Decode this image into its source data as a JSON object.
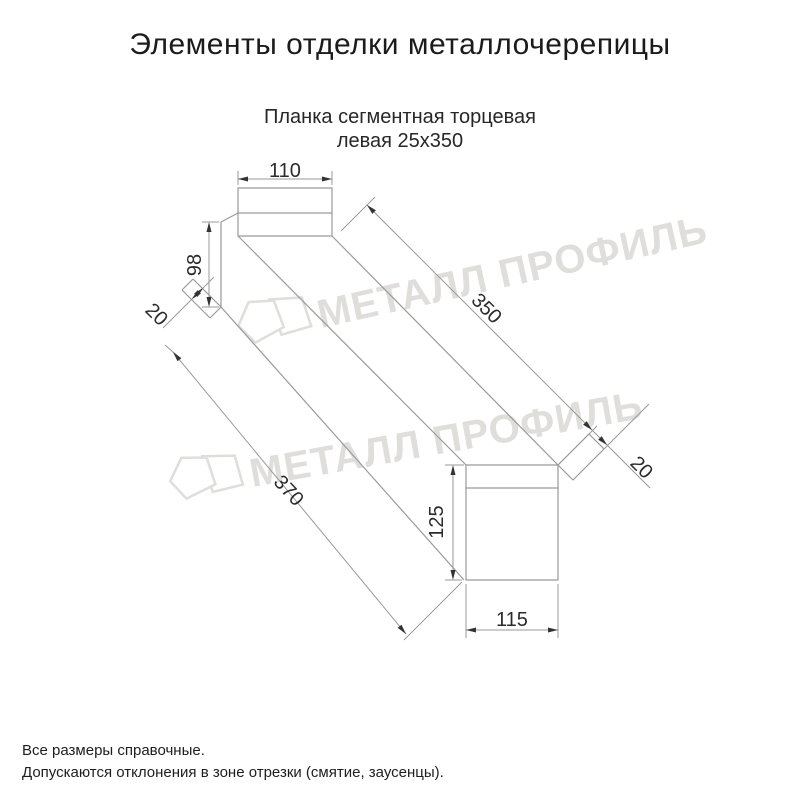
{
  "header": {
    "title": "Элементы отделки металлочерепицы"
  },
  "product": {
    "name_line1": "Планка сегментная торцевая",
    "name_line2": "левая 25х350"
  },
  "drawing": {
    "type": "dimensioned technical drawing of bent metal end strip, oblique view",
    "dimensions": {
      "top_flange_width": "110",
      "left_end_height": "98",
      "left_fold": "20",
      "top_edge_length": "350",
      "bottom_edge_length": "370",
      "right_end_height": "125",
      "right_fold": "20",
      "bottom_width": "115"
    }
  },
  "watermark": {
    "text": "МЕТАЛЛ ПРОФИЛЬ",
    "color": "#dfdedb"
  },
  "footer": {
    "note1": "Все размеры справочные.",
    "note2": "Допускаются отклонения в зоне отрезки (смятие, заусенцы)."
  },
  "colors": {
    "background": "#ffffff",
    "line": "#9a9a9a",
    "dimension_text": "#2b2b2b",
    "title_text": "#1b1b1b"
  }
}
